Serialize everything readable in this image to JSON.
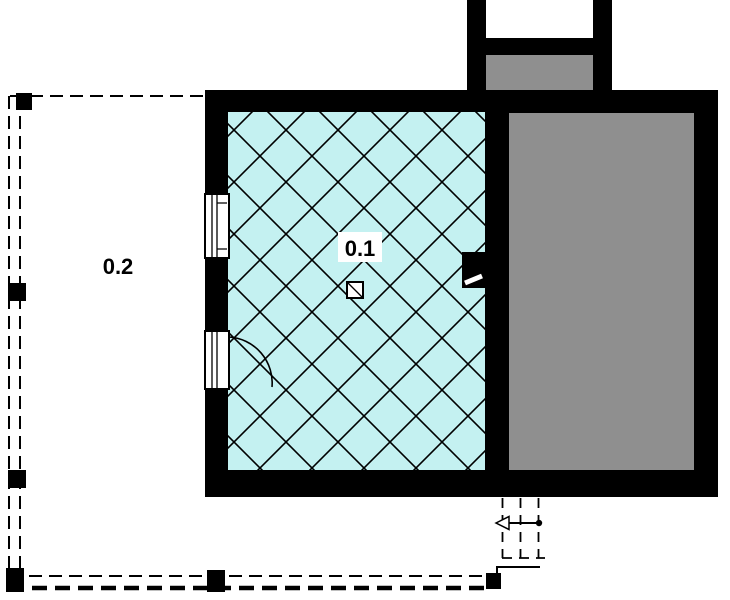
{
  "plan_labels": {
    "main_room": "0.1",
    "terrace": "0.2"
  },
  "colors": {
    "room_fill": "#c4f1f1",
    "garage_fill": "#8f8f8f",
    "wall": "#000000",
    "line": "#000000",
    "background": "#ffffff"
  }
}
